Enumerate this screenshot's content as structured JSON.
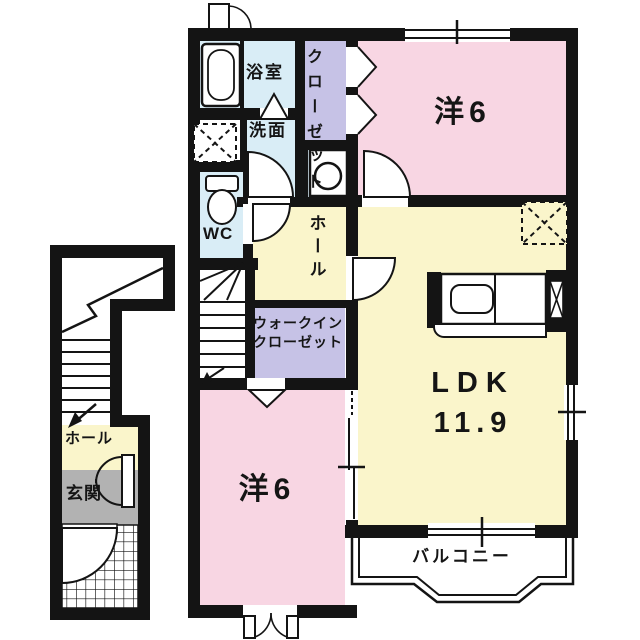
{
  "plan": {
    "title": "apartment-floor-plan",
    "rooms": {
      "bathroom": "浴室",
      "washroom": "洗面",
      "closet": "クローゼット",
      "wc": "WC",
      "hall_main": "ホール",
      "walkin_line1": "ウォークイン",
      "walkin_line2": "クローゼット",
      "western_top": "洋6",
      "western_bottom": "洋6",
      "ldk_name": "LDK",
      "ldk_size": "11.9",
      "balcony": "バルコニー",
      "hall_entry": "ホール",
      "entrance": "玄関"
    },
    "colors": {
      "room_pink": "#f8d6e3",
      "room_yellow": "#faf5cb",
      "closet_purple": "#c6c2e6",
      "wet_blue": "#d9edf6",
      "entrance_gray": "#b2b2b2",
      "wall": "#141414",
      "background": "#ffffff"
    }
  }
}
